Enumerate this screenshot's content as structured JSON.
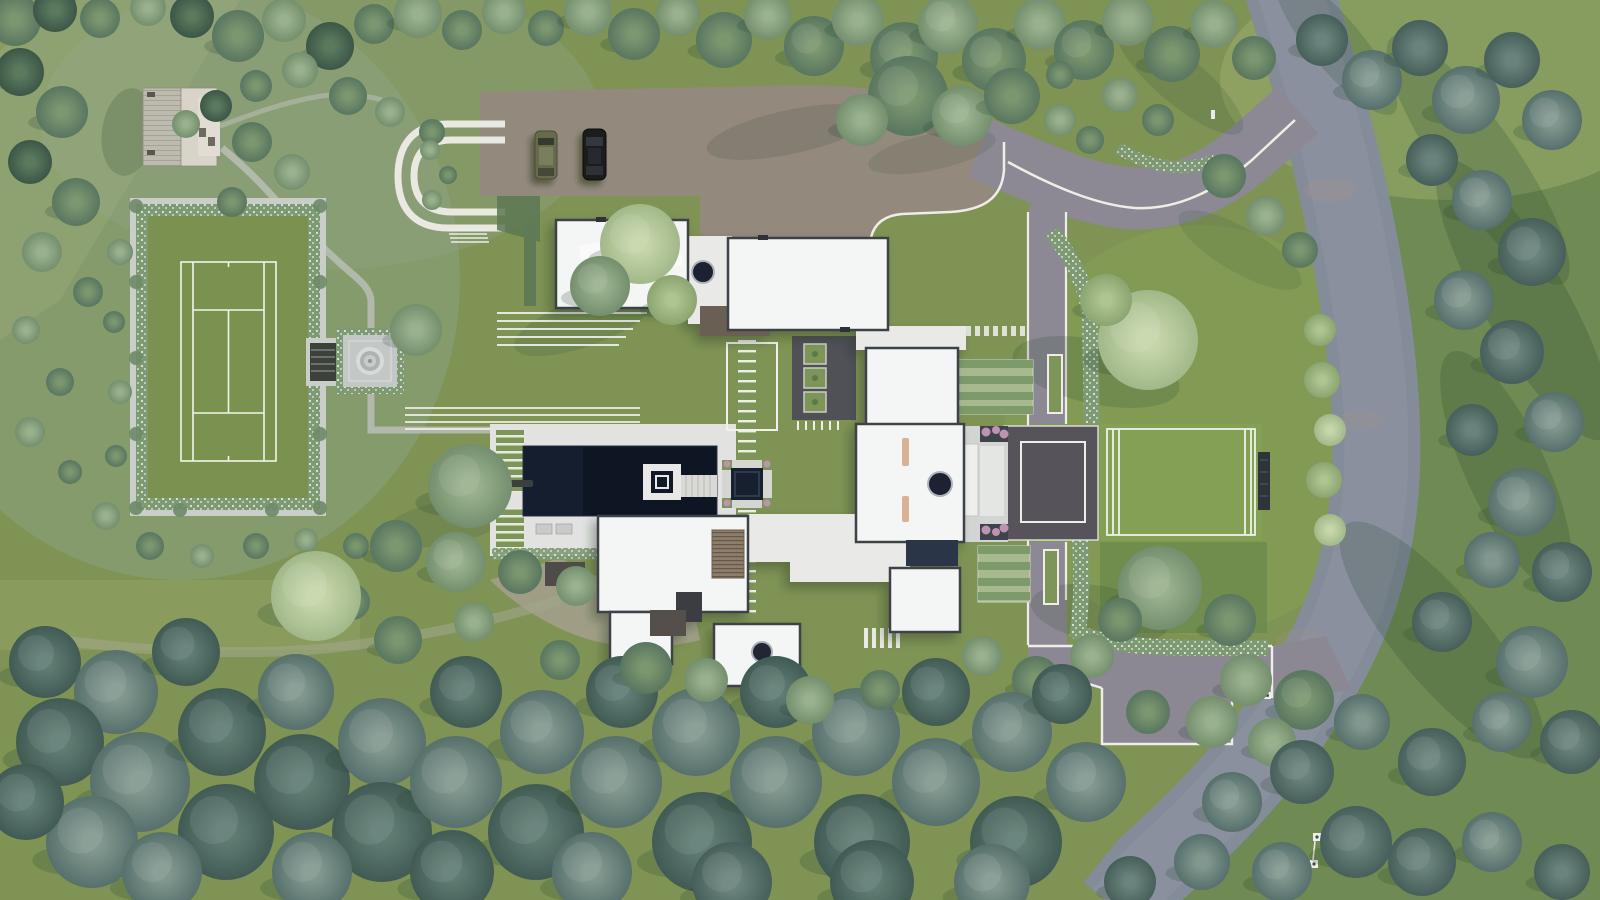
{
  "meta": {
    "type": "architectural-aerial-site-plan-rendering",
    "subject": "modern estate with tennis court, pool, motor court and woodland"
  },
  "palette": {
    "lawn": "#7F9355",
    "lawnSage": "#8EA383",
    "fieldDark": "#6F8A52",
    "fieldLight": "#9DAF6B",
    "road": "#848B99",
    "roadCenter": "#8E94A1",
    "drive": "#8C8994",
    "gravel": "#93897D",
    "curb": "#EFEEE6",
    "roof": "#F4F5F5",
    "roofEdge": "#3E4347",
    "slab": "#E9EAE8",
    "deckPaver": "#E2E3E0",
    "pool": "#0E1523",
    "poolIsland": "#E8E9E7",
    "courtGrass": "#7A9150",
    "courtLine": "#F2F5EA",
    "sportCourt": "#56535A",
    "grassCourt": "#83A155",
    "hedge": "#7E9A74",
    "stone": "#C9CFC8",
    "deckWood": "#BDBAAE",
    "pergola": "#8D7E6C",
    "glass": "#2B3646",
    "tan": "#D9B293",
    "pink": "#BD93AF",
    "carOlive": "#676B4D",
    "carBlack": "#1A1C1F",
    "ladder": "#7E9559",
    "parterre": "#4F5157",
    "shadow": "#24402C",
    "path": "#B7BDB2"
  },
  "features": [
    "wooden-deck",
    "tennis-court",
    "fountain-plaza",
    "loop-path",
    "motor-court",
    "suv-car",
    "black-car",
    "garage-roof",
    "main-house-roofs",
    "swimming-pool",
    "pool-island",
    "fire-pit-lounge",
    "ladder-path",
    "parterre-garden",
    "vegetable-garden",
    "sport-court",
    "grass-court",
    "entry-terrace",
    "driveway",
    "public-road",
    "woodland",
    "meadow"
  ],
  "trees": [
    [
      15,
      20,
      26,
      "m"
    ],
    [
      55,
      10,
      22,
      "d"
    ],
    [
      100,
      18,
      20,
      "m"
    ],
    [
      148,
      8,
      18,
      "s"
    ],
    [
      192,
      16,
      22,
      "d"
    ],
    [
      238,
      36,
      26,
      "m"
    ],
    [
      284,
      20,
      22,
      "s"
    ],
    [
      330,
      46,
      24,
      "d"
    ],
    [
      374,
      24,
      20,
      "m"
    ],
    [
      418,
      14,
      24,
      "s"
    ],
    [
      462,
      30,
      20,
      "m"
    ],
    [
      504,
      12,
      22,
      "s"
    ],
    [
      546,
      28,
      18,
      "m"
    ],
    [
      588,
      12,
      24,
      "s"
    ],
    [
      634,
      34,
      26,
      "m"
    ],
    [
      678,
      14,
      22,
      "s"
    ],
    [
      724,
      40,
      28,
      "m"
    ],
    [
      768,
      16,
      24,
      "s"
    ],
    [
      814,
      46,
      30,
      "m"
    ],
    [
      858,
      20,
      26,
      "s"
    ],
    [
      904,
      56,
      34,
      "m"
    ],
    [
      948,
      24,
      30,
      "s"
    ],
    [
      994,
      60,
      32,
      "m"
    ],
    [
      1040,
      24,
      26,
      "s"
    ],
    [
      1084,
      50,
      30,
      "m"
    ],
    [
      1128,
      20,
      26,
      "s"
    ],
    [
      1172,
      54,
      28,
      "m"
    ],
    [
      1214,
      24,
      24,
      "s"
    ],
    [
      1254,
      58,
      22,
      "m"
    ],
    [
      300,
      70,
      18,
      "s"
    ],
    [
      256,
      86,
      16,
      "m"
    ],
    [
      216,
      106,
      16,
      "d"
    ],
    [
      186,
      124,
      14,
      "s"
    ],
    [
      908,
      96,
      40,
      "m"
    ],
    [
      962,
      116,
      30,
      "s"
    ],
    [
      1012,
      96,
      28,
      "m"
    ],
    [
      862,
      120,
      26,
      "s"
    ],
    [
      20,
      72,
      24,
      "d"
    ],
    [
      62,
      112,
      26,
      "m"
    ],
    [
      30,
      162,
      22,
      "d"
    ],
    [
      76,
      202,
      24,
      "m"
    ],
    [
      42,
      252,
      20,
      "s"
    ],
    [
      88,
      292,
      15,
      "m"
    ],
    [
      26,
      330,
      14,
      "s"
    ],
    [
      60,
      382,
      14,
      "m"
    ],
    [
      30,
      432,
      15,
      "s"
    ],
    [
      70,
      472,
      12,
      "m"
    ],
    [
      106,
      516,
      14,
      "s"
    ],
    [
      150,
      546,
      14,
      "m"
    ],
    [
      202,
      556,
      12,
      "s"
    ],
    [
      256,
      546,
      13,
      "m"
    ],
    [
      306,
      540,
      12,
      "s"
    ],
    [
      356,
      546,
      13,
      "m"
    ],
    [
      120,
      252,
      13,
      "s"
    ],
    [
      114,
      322,
      11,
      "m"
    ],
    [
      120,
      392,
      12,
      "s"
    ],
    [
      116,
      456,
      11,
      "m"
    ],
    [
      252,
      142,
      20,
      "m"
    ],
    [
      292,
      172,
      18,
      "s"
    ],
    [
      232,
      202,
      15,
      "m"
    ],
    [
      348,
      96,
      19,
      "m"
    ],
    [
      390,
      112,
      15,
      "s"
    ],
    [
      432,
      132,
      13,
      "m"
    ],
    [
      430,
      150,
      10,
      "s"
    ],
    [
      448,
      175,
      9,
      "m"
    ],
    [
      432,
      200,
      10,
      "s"
    ],
    [
      640,
      244,
      40,
      "p"
    ],
    [
      600,
      286,
      30,
      "s"
    ],
    [
      672,
      300,
      25,
      "l"
    ],
    [
      416,
      330,
      26,
      "s"
    ],
    [
      470,
      486,
      42,
      "s"
    ],
    [
      396,
      546,
      26,
      "m"
    ],
    [
      456,
      562,
      30,
      "s"
    ],
    [
      520,
      572,
      22,
      "m"
    ],
    [
      576,
      586,
      20,
      "s"
    ],
    [
      1148,
      340,
      50,
      "p"
    ],
    [
      1106,
      300,
      26,
      "l"
    ],
    [
      1224,
      176,
      22,
      "m"
    ],
    [
      1266,
      216,
      20,
      "s"
    ],
    [
      1300,
      250,
      18,
      "m"
    ],
    [
      1160,
      588,
      42,
      "s"
    ],
    [
      1230,
      620,
      26,
      "m"
    ],
    [
      1092,
      656,
      22,
      "s"
    ],
    [
      1036,
      680,
      24,
      "m"
    ],
    [
      982,
      656,
      20,
      "s"
    ],
    [
      1120,
      620,
      22,
      "m"
    ],
    [
      1246,
      680,
      26,
      "s"
    ],
    [
      1304,
      700,
      30,
      "m"
    ],
    [
      1212,
      722,
      26,
      "s"
    ],
    [
      1148,
      712,
      22,
      "m"
    ],
    [
      1272,
      742,
      24,
      "s"
    ],
    [
      1060,
      120,
      16,
      "s"
    ],
    [
      1090,
      140,
      14,
      "m"
    ],
    [
      1120,
      95,
      18,
      "s"
    ],
    [
      1158,
      120,
      16,
      "m"
    ],
    [
      1060,
      75,
      14,
      "m"
    ],
    [
      1322,
      380,
      18,
      "l"
    ],
    [
      1330,
      430,
      16,
      "p"
    ],
    [
      1324,
      480,
      18,
      "l"
    ],
    [
      1330,
      530,
      16,
      "p"
    ],
    [
      1320,
      330,
      16,
      "l"
    ],
    [
      1322,
      40,
      26,
      "t"
    ],
    [
      1372,
      80,
      30,
      "b"
    ],
    [
      1420,
      48,
      28,
      "t"
    ],
    [
      1466,
      100,
      34,
      "b"
    ],
    [
      1512,
      60,
      28,
      "t"
    ],
    [
      1552,
      120,
      30,
      "b"
    ],
    [
      1432,
      160,
      26,
      "t"
    ],
    [
      1482,
      200,
      30,
      "b"
    ],
    [
      1532,
      252,
      34,
      "t"
    ],
    [
      1464,
      300,
      30,
      "b"
    ],
    [
      1512,
      352,
      32,
      "t"
    ],
    [
      1554,
      422,
      30,
      "b"
    ],
    [
      1472,
      430,
      26,
      "t"
    ],
    [
      1522,
      502,
      34,
      "b"
    ],
    [
      1562,
      572,
      30,
      "t"
    ],
    [
      1492,
      560,
      28,
      "b"
    ],
    [
      1442,
      622,
      30,
      "t"
    ],
    [
      1532,
      662,
      36,
      "b"
    ],
    [
      1572,
      742,
      32,
      "t"
    ],
    [
      1502,
      722,
      30,
      "b"
    ],
    [
      1432,
      762,
      34,
      "t"
    ],
    [
      1362,
      722,
      28,
      "b"
    ],
    [
      1302,
      772,
      32,
      "t"
    ],
    [
      1356,
      842,
      36,
      "t"
    ],
    [
      1282,
      872,
      30,
      "b"
    ],
    [
      1422,
      862,
      34,
      "t"
    ],
    [
      1492,
      842,
      30,
      "b"
    ],
    [
      1562,
      872,
      28,
      "t"
    ],
    [
      1202,
      862,
      28,
      "b"
    ],
    [
      1130,
      882,
      26,
      "t"
    ],
    [
      1232,
      802,
      30,
      "b"
    ],
    [
      45,
      662,
      36,
      "w"
    ],
    [
      116,
      692,
      42,
      "b"
    ],
    [
      186,
      652,
      34,
      "w"
    ],
    [
      60,
      742,
      44,
      "w"
    ],
    [
      140,
      782,
      50,
      "b"
    ],
    [
      222,
      732,
      44,
      "w"
    ],
    [
      296,
      692,
      38,
      "b"
    ],
    [
      302,
      782,
      48,
      "w"
    ],
    [
      382,
      742,
      44,
      "b"
    ],
    [
      226,
      832,
      48,
      "w"
    ],
    [
      92,
      842,
      46,
      "b"
    ],
    [
      26,
      802,
      38,
      "w"
    ],
    [
      382,
      832,
      50,
      "w"
    ],
    [
      456,
      782,
      46,
      "b"
    ],
    [
      466,
      692,
      36,
      "w"
    ],
    [
      542,
      732,
      42,
      "b"
    ],
    [
      536,
      832,
      48,
      "w"
    ],
    [
      616,
      782,
      46,
      "b"
    ],
    [
      622,
      692,
      36,
      "w"
    ],
    [
      696,
      732,
      44,
      "b"
    ],
    [
      702,
      842,
      50,
      "w"
    ],
    [
      776,
      782,
      46,
      "b"
    ],
    [
      776,
      692,
      36,
      "w"
    ],
    [
      856,
      732,
      44,
      "b"
    ],
    [
      862,
      842,
      48,
      "w"
    ],
    [
      936,
      782,
      44,
      "b"
    ],
    [
      936,
      692,
      34,
      "w"
    ],
    [
      1012,
      732,
      40,
      "b"
    ],
    [
      1016,
      842,
      46,
      "w"
    ],
    [
      1086,
      782,
      40,
      "b"
    ],
    [
      162,
      872,
      40,
      "b"
    ],
    [
      452,
      872,
      42,
      "w"
    ],
    [
      592,
      872,
      40,
      "b"
    ],
    [
      872,
      882,
      42,
      "w"
    ],
    [
      992,
      882,
      38,
      "b"
    ],
    [
      312,
      872,
      40,
      "b"
    ],
    [
      732,
      882,
      40,
      "t"
    ],
    [
      1062,
      694,
      30,
      "w"
    ],
    [
      352,
      602,
      18,
      "m"
    ],
    [
      398,
      640,
      24,
      "m"
    ],
    [
      474,
      622,
      20,
      "s"
    ],
    [
      316,
      596,
      45,
      "p"
    ],
    [
      646,
      668,
      26,
      "m"
    ],
    [
      706,
      680,
      22,
      "s"
    ],
    [
      560,
      660,
      20,
      "m"
    ],
    [
      810,
      700,
      24,
      "s"
    ],
    [
      880,
      690,
      20,
      "m"
    ]
  ],
  "shadows": [
    [
      1478,
      160,
      150,
      38,
      55,
      0.2
    ],
    [
      1524,
      300,
      160,
      42,
      60,
      0.22
    ],
    [
      1506,
      470,
      130,
      40,
      65,
      0.2
    ],
    [
      1442,
      640,
      150,
      45,
      50,
      0.2
    ],
    [
      1336,
      44,
      90,
      26,
      50,
      0.18
    ],
    [
      285,
      360,
      26,
      95,
      0,
      0.16
    ],
    [
      226,
      472,
      80,
      16,
      0,
      0.15
    ],
    [
      1096,
      372,
      85,
      32,
      12,
      0.18
    ],
    [
      1100,
      614,
      70,
      28,
      10,
      0.16
    ],
    [
      790,
      132,
      85,
      22,
      -12,
      0.14
    ],
    [
      932,
      152,
      65,
      18,
      -12,
      0.12
    ],
    [
      585,
      322,
      75,
      24,
      -20,
      0.14
    ],
    [
      448,
      522,
      68,
      22,
      -12,
      0.13
    ],
    [
      128,
      132,
      26,
      44,
      8,
      0.2
    ],
    [
      1180,
      80,
      80,
      24,
      40,
      0.15
    ],
    [
      1240,
      250,
      70,
      22,
      30,
      0.12
    ]
  ]
}
